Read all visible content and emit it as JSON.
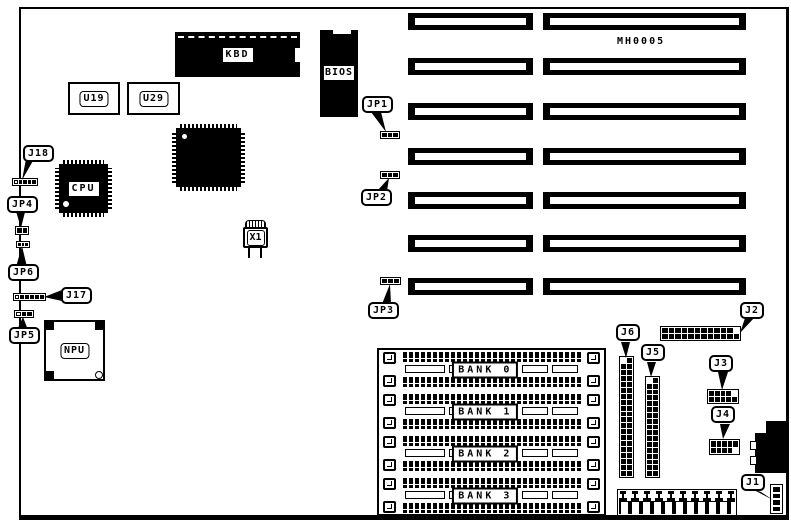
{
  "board": {
    "model": "MH0005"
  },
  "chips": {
    "kbd": "KBD",
    "bios": "BIOS",
    "u19": "U19",
    "u29": "U29",
    "cpu": "CPU",
    "npu": "NPU",
    "x1": "X1"
  },
  "banks": [
    "BANK 0",
    "BANK 1",
    "BANK 2",
    "BANK 3"
  ],
  "jumpers": {
    "j18": {
      "label": "J18",
      "pins": 5,
      "first_pin_white": true
    },
    "jp4": {
      "label": "JP4",
      "pins": 2,
      "first_pin_white": false
    },
    "jp6": {
      "label": "JP6",
      "pins": 3,
      "first_pin_white": false
    },
    "j17": {
      "label": "J17",
      "pins": 6,
      "first_pin_white": true
    },
    "jp5": {
      "label": "JP5",
      "pins": 3,
      "first_pin_white": true
    },
    "jp1": {
      "label": "JP1",
      "pins": 3,
      "first_pin_white": false
    },
    "jp2": {
      "label": "JP2",
      "pins": 3,
      "first_pin_white": false
    },
    "jp3": {
      "label": "JP3",
      "pins": 3,
      "first_pin_white": false
    }
  },
  "connectors": {
    "j6": {
      "label": "J6",
      "rows": 20,
      "cols": 2,
      "pin1_index": 0
    },
    "j5": {
      "label": "J5",
      "rows": 17,
      "cols": 2,
      "pin1_index": 0
    },
    "j2": {
      "label": "J2",
      "rows": 2,
      "cols": 12,
      "pin1_index": 11
    },
    "j3": {
      "label": "J3",
      "rows": 2,
      "cols": 5,
      "pin1_index": 4
    },
    "j4": {
      "label": "J4",
      "rows": 2,
      "cols": 5,
      "pin1_index": 9
    },
    "j1": {
      "label": "J1",
      "rows": 4,
      "cols": 1,
      "pin1_index": -1
    }
  },
  "expansion_slots": {
    "count": 7
  },
  "colors": {
    "ink": "#000000",
    "paper": "#ffffff"
  }
}
